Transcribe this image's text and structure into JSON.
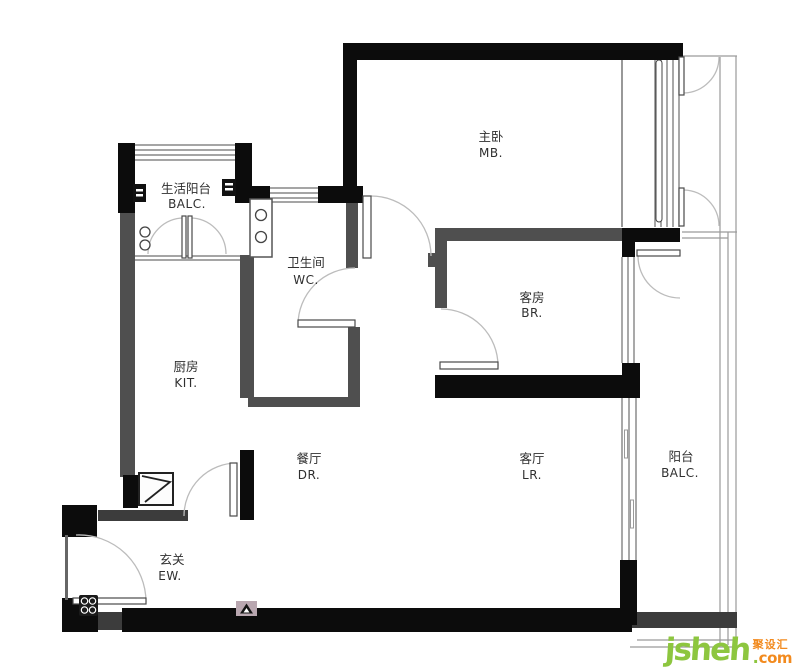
{
  "watermark": {
    "brand": "jsheh",
    "dot": ".",
    "suffix": "com",
    "chinese": "聚设汇"
  },
  "colors": {
    "wall_black": "#0c0c0c",
    "wall_gray": "#4f4f4f",
    "brand_green": "#8dc63f",
    "brand_orange": "#f28a1e"
  },
  "rooms": {
    "service_balcony": {
      "cn": "生活阳台",
      "en": "BALC."
    },
    "master_bedroom": {
      "cn": "主卧",
      "en": "MB."
    },
    "bathroom": {
      "cn": "卫生间",
      "en": "WC."
    },
    "guest_bedroom": {
      "cn": "客房",
      "en": "BR."
    },
    "kitchen": {
      "cn": "厨房",
      "en": "KIT."
    },
    "dining": {
      "cn": "餐厅",
      "en": "DR."
    },
    "living": {
      "cn": "客厅",
      "en": "LR."
    },
    "balcony": {
      "cn": "阳台",
      "en": "BALC."
    },
    "entry": {
      "cn": "玄关",
      "en": "EW."
    }
  }
}
